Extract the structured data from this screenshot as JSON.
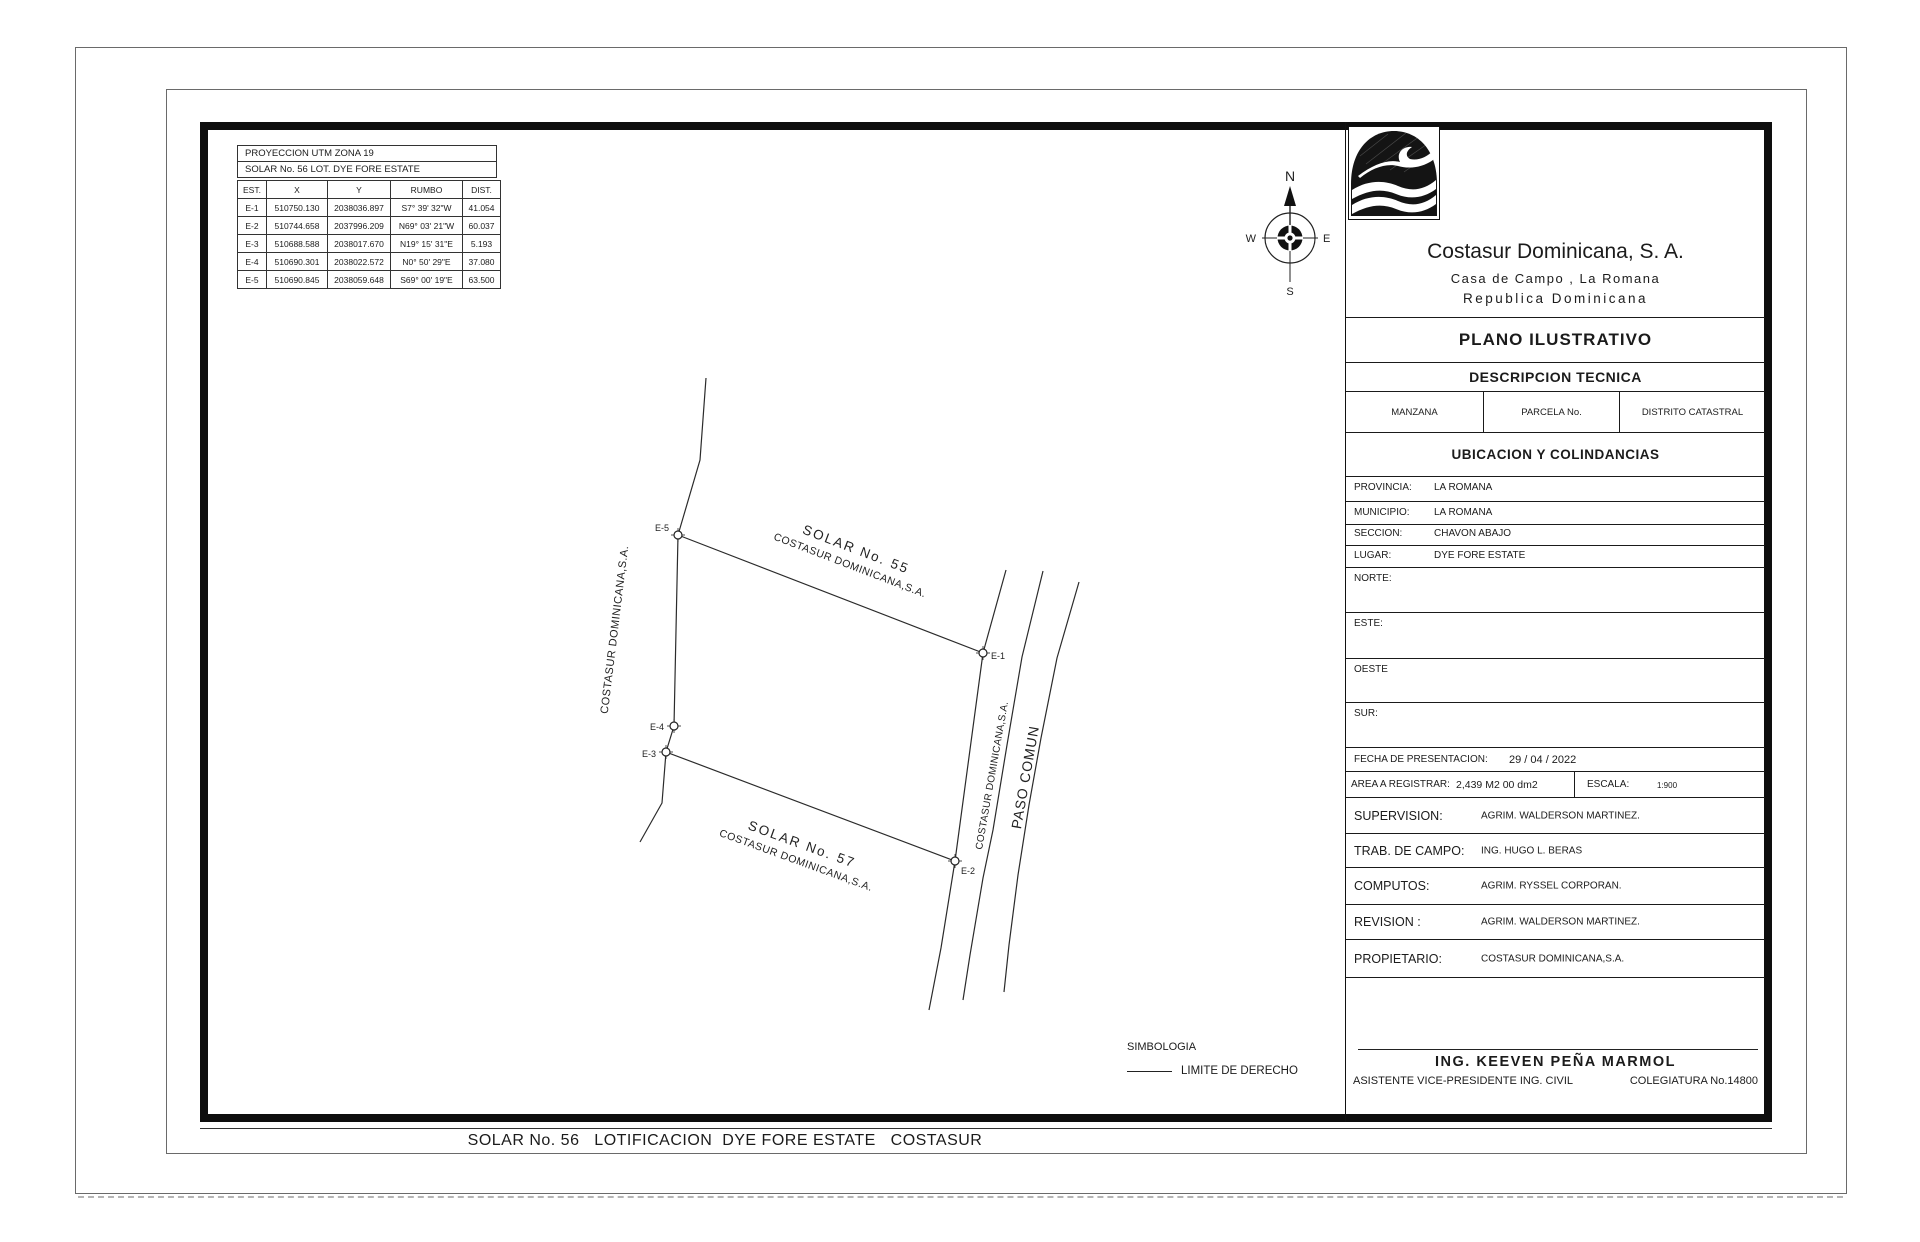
{
  "page": {
    "bottom_title": "SOLAR No. 56   LOTIFICACION  DYE FORE ESTATE   COSTASUR"
  },
  "projection_table": {
    "line1": "PROYECCION UTM ZONA 19",
    "line2": "SOLAR No. 56 LOT. DYE FORE ESTATE"
  },
  "coord_table": {
    "headers": [
      "EST.",
      "X",
      "Y",
      "RUMBO",
      "DIST."
    ],
    "rows": [
      {
        "est": "E-1",
        "x": "510750.130",
        "y": "2038036.897",
        "rumbo": "S7° 39' 32\"W",
        "dist": "41.054"
      },
      {
        "est": "E-2",
        "x": "510744.658",
        "y": "2037996.209",
        "rumbo": "N69° 03' 21\"W",
        "dist": "60.037"
      },
      {
        "est": "E-3",
        "x": "510688.588",
        "y": "2038017.670",
        "rumbo": "N19° 15' 31\"E",
        "dist": "5.193"
      },
      {
        "est": "E-4",
        "x": "510690.301",
        "y": "2038022.572",
        "rumbo": "N0° 50' 29\"E",
        "dist": "37.080"
      },
      {
        "est": "E-5",
        "x": "510690.845",
        "y": "2038059.648",
        "rumbo": "S69° 00' 19\"E",
        "dist": "63.500"
      }
    ]
  },
  "compass": {
    "n": "N",
    "s": "S",
    "e": "E",
    "w": "W"
  },
  "plot": {
    "solar55_line1": "SOLAR No. 55",
    "solar55_line2": "COSTASUR DOMINICANA,S.A.",
    "solar57_line1": "SOLAR No. 57",
    "solar57_line2": "COSTASUR DOMINICANA,S.A.",
    "west_owner": "COSTASUR DOMINICANA,S.A.",
    "road_owner": "COSTASUR DOMINICANA,S.A.",
    "road_name": "PASO COMUN",
    "points": {
      "e1": "E-1",
      "e2": "E-2",
      "e3": "E-3",
      "e4": "E-4",
      "e5": "E-5"
    }
  },
  "legend": {
    "title": "SIMBOLOGIA",
    "limit_label": "LIMITE DE DERECHO"
  },
  "title_block": {
    "company": "Costasur Dominicana, S. A.",
    "address": "Casa de Campo , La Romana",
    "country": "Republica Dominicana",
    "plan_type": "PLANO ILUSTRATIVO",
    "section_title": "DESCRIPCION TECNICA",
    "cadastral": {
      "c1": "MANZANA",
      "c2": "PARCELA No.",
      "c3": "DISTRITO CATASTRAL"
    },
    "location_title": "UBICACION Y COLINDANCIAS",
    "location_rows": [
      {
        "label": "PROVINCIA:",
        "value": "LA ROMANA"
      },
      {
        "label": "MUNICIPIO:",
        "value": "LA ROMANA"
      },
      {
        "label": "SECCION:",
        "value": "CHAVON ABAJO"
      },
      {
        "label": "LUGAR:",
        "value": "DYE FORE ESTATE"
      },
      {
        "label": "NORTE:",
        "value": ""
      },
      {
        "label": "ESTE:",
        "value": ""
      },
      {
        "label": "OESTE",
        "value": ""
      },
      {
        "label": "SUR:",
        "value": ""
      }
    ],
    "fecha_label": "FECHA DE PRESENTACION:",
    "fecha_value": "29 / 04 / 2022",
    "area_label": "AREA A REGISTRAR:",
    "area_value": "2,439 M2 00 dm2",
    "escala_label": "ESCALA:",
    "escala_value": "1:900",
    "staff_rows": [
      {
        "label": "SUPERVISION:",
        "value": "AGRIM. WALDERSON MARTINEZ."
      },
      {
        "label": "TRAB. DE CAMPO:",
        "value": "ING. HUGO L. BERAS"
      },
      {
        "label": "COMPUTOS:",
        "value": "AGRIM. RYSSEL CORPORAN."
      },
      {
        "label": "REVISION :",
        "value": "AGRIM. WALDERSON MARTINEZ."
      },
      {
        "label": "PROPIETARIO:",
        "value": "COSTASUR DOMINICANA,S.A."
      }
    ],
    "engineer_name": "ING. KEEVEN PEÑA MARMOL",
    "engineer_title": "ASISTENTE VICE-PRESIDENTE ING. CIVIL",
    "engineer_license": "COLEGIATURA No.14800"
  }
}
